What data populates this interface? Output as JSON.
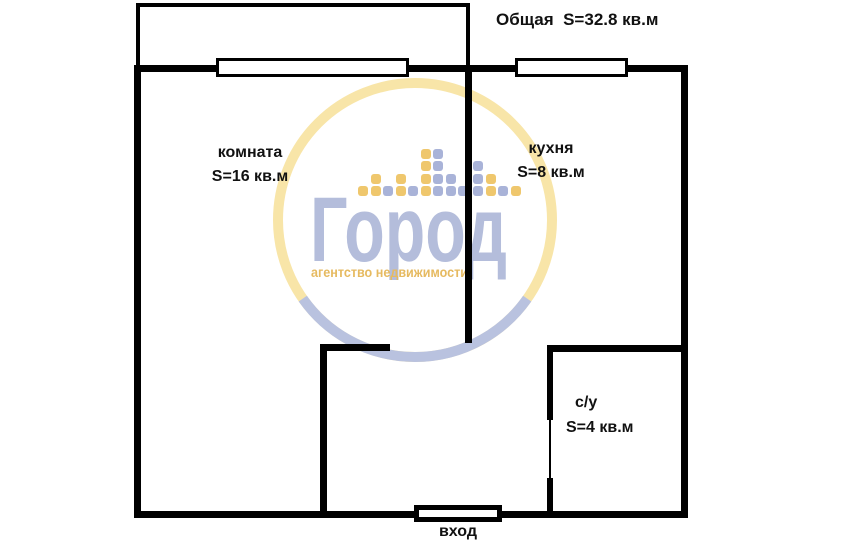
{
  "plan": {
    "title": "Общая  S=32.8 кв.м",
    "rooms": [
      {
        "name": "комната",
        "area": "S=16 кв.м"
      },
      {
        "name": "кухня",
        "area": "S=8 кв.м"
      },
      {
        "name": "с/у",
        "area": "S=4 кв.м"
      }
    ],
    "entrance_label": "вход",
    "wall_color": "#000000",
    "text_color": "#111111"
  },
  "watermark": {
    "brand": "Город",
    "tagline": "агентство недвижимости",
    "colors": {
      "ring_yellow": "#f8e5a8",
      "ring_lavender": "#b9c2df",
      "square_yellow": "#efc76d",
      "square_lavender": "#a9b3d8",
      "brand_text": "#b4bddb",
      "tagline_text": "#e6ba60"
    },
    "equalizer_columns": [
      {
        "x": 358,
        "cells": [
          "Y"
        ]
      },
      {
        "x": 371,
        "cells": [
          "Y",
          "Y"
        ]
      },
      {
        "x": 383,
        "cells": [
          "L"
        ]
      },
      {
        "x": 396,
        "cells": [
          "Y",
          "Y"
        ]
      },
      {
        "x": 408,
        "cells": [
          "L"
        ]
      },
      {
        "x": 421,
        "cells": [
          "Y",
          "Y",
          "Y",
          "Y"
        ]
      },
      {
        "x": 433,
        "cells": [
          "L",
          "L",
          "L",
          "L"
        ]
      },
      {
        "x": 446,
        "cells": [
          "L",
          "L"
        ]
      },
      {
        "x": 458,
        "cells": [
          "L"
        ]
      },
      {
        "x": 473,
        "cells": [
          "L",
          "L",
          "L"
        ]
      },
      {
        "x": 486,
        "cells": [
          "Y",
          "Y"
        ]
      },
      {
        "x": 498,
        "cells": [
          "L"
        ]
      },
      {
        "x": 511,
        "cells": [
          "Y"
        ]
      }
    ]
  }
}
